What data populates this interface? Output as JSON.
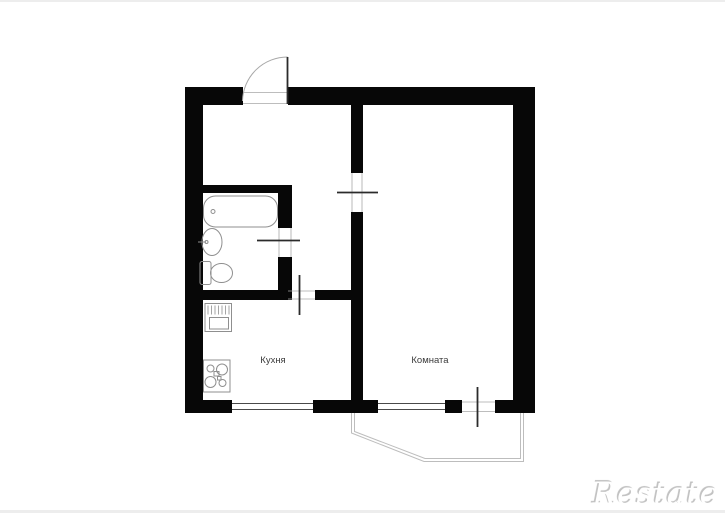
{
  "plan": {
    "rooms": [
      {
        "name": "kitchen",
        "label": "Кухня"
      },
      {
        "name": "room",
        "label": "Комната"
      }
    ],
    "features": [
      "entrance-door",
      "bathtub",
      "wash-basin",
      "toilet",
      "kitchen-sink",
      "stove",
      "window-kitchen",
      "window-room",
      "balcony-door",
      "balcony-outline",
      "interior-doors"
    ]
  },
  "watermark": {
    "text": "Restate"
  },
  "colors": {
    "background": "#ffffff",
    "wall": "#070707",
    "fixture": "#8f8f8f",
    "door_leaf": "#2b2b2b",
    "thin_edge": "#a8a8a8",
    "window": "#4a4a4a",
    "balcony": "#bdbdbd",
    "label": "#3c3c3c",
    "watermark_fill": "#ffffff",
    "watermark_shadow": "#c2c2c2"
  }
}
